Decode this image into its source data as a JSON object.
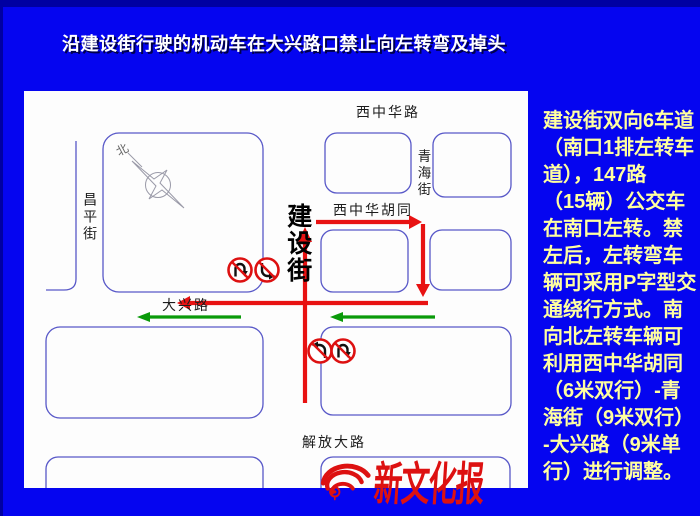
{
  "slide": {
    "title": "沿建设街行驶的机动车在大兴路口禁止向左转弯及掉头"
  },
  "map": {
    "labels": {
      "west_zhonghua_road": "西中华路",
      "qinghai_street": "青海街",
      "west_zhonghua_hutong": "西中华胡同",
      "jianshe_street": "建设街",
      "changping_street": "昌平街",
      "daxing_road": "大兴路",
      "jiefang_road": "解放大路"
    },
    "compass_north": "北"
  },
  "sidebar": {
    "lines": [
      "建设街双向6车道",
      "（南口1排左转车",
      "道），147路",
      "（15辆）公交车",
      "在南口左转。禁",
      "左后，左转弯车",
      "辆可采用P字型交",
      "通绕行方式。南",
      "向北左转车辆可",
      "利用西中华胡同",
      "（6米双行）-青",
      "海街（9米双行）",
      "-大兴路（9米单",
      "行）进行调整。"
    ]
  },
  "logo": {
    "text": "新文化报"
  },
  "colors": {
    "background_blue": "#0505f0",
    "route_red": "#e81212",
    "flow_green": "#0a9a0a",
    "block_outline": "#5858c8",
    "sidebar_text": "#ffffa0",
    "logo_red": "#dd1111"
  }
}
